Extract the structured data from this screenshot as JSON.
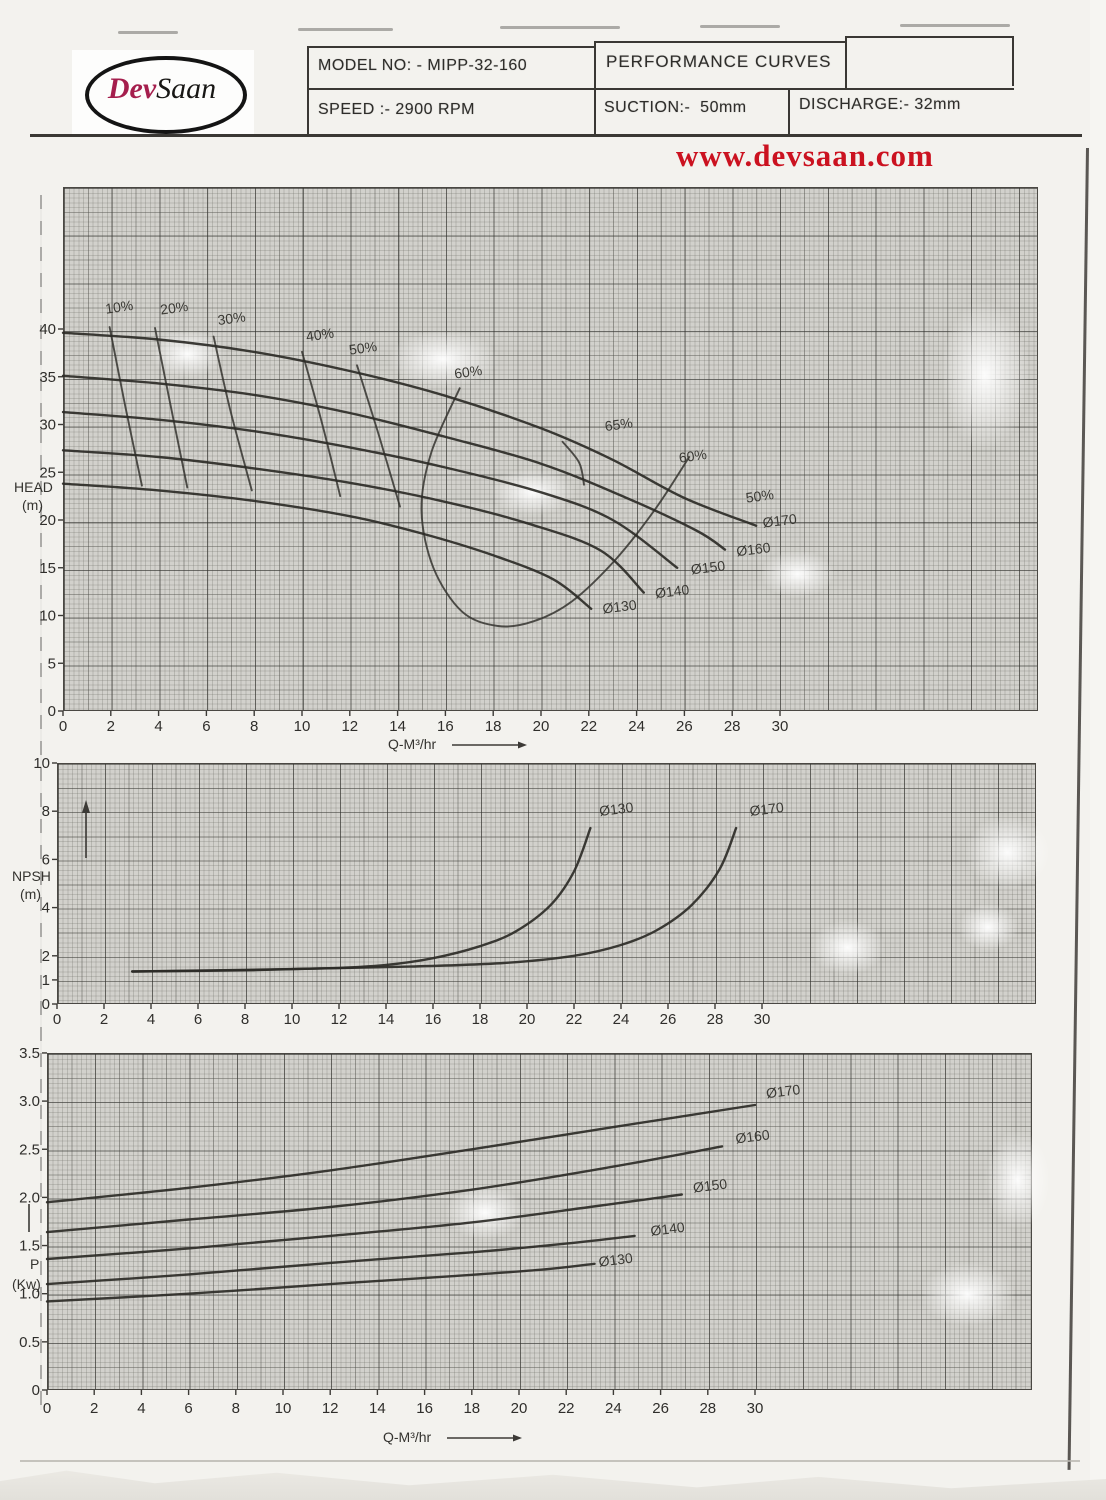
{
  "header": {
    "logo": {
      "text_red": "Dev",
      "text_black": "Saan"
    },
    "model": "MODEL NO: - MIPP-32-160",
    "title": "PERFORMANCE CURVES",
    "speed": "SPEED :- 2900 RPM",
    "suction": "SUCTION:-  50mm",
    "discharge": "DISCHARGE:- 32mm",
    "website": "www.devsaan.com"
  },
  "chart_data": [
    {
      "type": "line",
      "title": "Head capacity curves with impeller diameters and efficiency contours",
      "xlabel": "Q-M³/hr",
      "ylabel": "HEAD (m)",
      "ylabel_lines": [
        "HEAD",
        "(m)"
      ],
      "xlim": [
        0,
        40.8
      ],
      "ylim": [
        0,
        54.9
      ],
      "grid": true,
      "legend_position": "inline-labels",
      "xticks": [
        0,
        2,
        4,
        6,
        8,
        10,
        12,
        14,
        16,
        18,
        20,
        22,
        24,
        26,
        28,
        30
      ],
      "yticks": [
        [
          0,
          "0"
        ],
        [
          5,
          "5"
        ],
        [
          10,
          "10"
        ],
        [
          15,
          "15"
        ],
        [
          20,
          "20"
        ],
        [
          25,
          "25"
        ],
        [
          30,
          "30"
        ],
        [
          35,
          "35"
        ],
        [
          40,
          "40"
        ]
      ],
      "series": [
        {
          "name": "Ø170",
          "label_at": [
            29.3,
            19.2
          ],
          "points": [
            [
              0,
              39.6
            ],
            [
              4,
              38.9
            ],
            [
              8,
              37.6
            ],
            [
              12,
              35.6
            ],
            [
              16,
              33.0
            ],
            [
              20,
              29.6
            ],
            [
              23,
              26.3
            ],
            [
              26,
              22.3
            ],
            [
              29,
              19.4
            ]
          ]
        },
        {
          "name": "Ø160",
          "label_at": [
            28.2,
            16.2
          ],
          "points": [
            [
              0,
              35.1
            ],
            [
              4,
              34.3
            ],
            [
              8,
              33.1
            ],
            [
              12,
              31.2
            ],
            [
              16,
              28.7
            ],
            [
              20,
              25.9
            ],
            [
              23.5,
              22.4
            ],
            [
              26.5,
              18.9
            ],
            [
              27.7,
              16.9
            ]
          ]
        },
        {
          "name": "Ø150",
          "label_at": [
            26.3,
            14.3
          ],
          "points": [
            [
              0,
              31.3
            ],
            [
              4,
              30.5
            ],
            [
              8,
              29.3
            ],
            [
              12,
              27.6
            ],
            [
              16,
              25.5
            ],
            [
              20,
              22.9
            ],
            [
              23,
              20.0
            ],
            [
              25.7,
              15.0
            ]
          ]
        },
        {
          "name": "Ø140",
          "label_at": [
            24.8,
            11.8
          ],
          "points": [
            [
              0,
              27.3
            ],
            [
              4,
              26.6
            ],
            [
              8,
              25.4
            ],
            [
              12,
              23.9
            ],
            [
              16,
              21.9
            ],
            [
              19.5,
              19.6
            ],
            [
              22.5,
              16.8
            ],
            [
              24.3,
              12.4
            ]
          ]
        },
        {
          "name": "Ø130",
          "label_at": [
            22.6,
            10.2
          ],
          "points": [
            [
              0,
              23.8
            ],
            [
              4,
              23.1
            ],
            [
              8,
              22.0
            ],
            [
              12,
              20.4
            ],
            [
              15,
              18.6
            ],
            [
              18,
              16.3
            ],
            [
              20.5,
              13.8
            ],
            [
              22.1,
              10.7
            ]
          ]
        }
      ],
      "efficiency_lines": [
        {
          "label": "10%",
          "points": [
            [
              1.95,
              40.2
            ],
            [
              2.6,
              32.0
            ],
            [
              3.3,
              23.6
            ]
          ]
        },
        {
          "label": "20%",
          "points": [
            [
              3.85,
              40.1
            ],
            [
              4.5,
              32.0
            ],
            [
              5.2,
              23.4
            ]
          ]
        },
        {
          "label": "30%",
          "points": [
            [
              6.3,
              39.2
            ],
            [
              7.0,
              31.5
            ],
            [
              7.9,
              23.1
            ]
          ]
        },
        {
          "label": "40%",
          "points": [
            [
              10.0,
              37.6
            ],
            [
              10.8,
              30.5
            ],
            [
              11.6,
              22.5
            ]
          ]
        },
        {
          "label": "50%",
          "points": [
            [
              12.3,
              36.2
            ],
            [
              13.2,
              29.0
            ],
            [
              14.1,
              21.4
            ]
          ]
        },
        {
          "label": "60%",
          "points": [
            [
              16.6,
              33.8
            ],
            [
              15.4,
              27.0
            ],
            [
              15.0,
              21.0
            ],
            [
              15.5,
              15.0
            ],
            [
              16.7,
              10.4
            ],
            [
              18.2,
              8.9
            ],
            [
              19.7,
              9.4
            ],
            [
              21.3,
              11.5
            ],
            [
              23.1,
              15.8
            ],
            [
              24.8,
              21.2
            ],
            [
              26.2,
              26.6
            ]
          ]
        },
        {
          "label": "65%",
          "points": [
            [
              20.9,
              28.2
            ],
            [
              21.6,
              26.0
            ],
            [
              21.8,
              23.7
            ]
          ]
        }
      ],
      "efficiency_labels": [
        {
          "text": "10%",
          "at": [
            1.8,
            41.6
          ]
        },
        {
          "text": "20%",
          "at": [
            4.1,
            41.5
          ]
        },
        {
          "text": "30%",
          "at": [
            6.5,
            40.4
          ]
        },
        {
          "text": "40%",
          "at": [
            10.2,
            38.7
          ]
        },
        {
          "text": "50%",
          "at": [
            12.0,
            37.3
          ]
        },
        {
          "text": "60%",
          "at": [
            16.4,
            34.8
          ]
        },
        {
          "text": "65%",
          "at": [
            22.7,
            29.3
          ]
        },
        {
          "text": "60%",
          "at": [
            25.8,
            26.0
          ]
        },
        {
          "text": "50%",
          "at": [
            28.6,
            21.8
          ]
        }
      ]
    },
    {
      "type": "line",
      "title": "NPSH curves",
      "xlabel": "",
      "ylabel": "NPSH (m)",
      "ylabel_lines": [
        "NPSH",
        "(m)"
      ],
      "xlim": [
        0,
        41.7
      ],
      "ylim": [
        0,
        10
      ],
      "grid": true,
      "legend_position": "inline-labels",
      "xticks": [
        0,
        2,
        4,
        6,
        8,
        10,
        12,
        14,
        16,
        18,
        20,
        22,
        24,
        26,
        28,
        30
      ],
      "yticks": [
        [
          0,
          "0"
        ],
        [
          1,
          "1"
        ],
        [
          2,
          "2"
        ],
        [
          4,
          "4"
        ],
        [
          6,
          "6"
        ],
        [
          8,
          "8"
        ],
        [
          10,
          "10"
        ]
      ],
      "series": [
        {
          "name": "Ø130",
          "label_at": [
            23.1,
            7.8
          ],
          "points": [
            [
              3.2,
              1.35
            ],
            [
              8,
              1.4
            ],
            [
              12,
              1.5
            ],
            [
              14,
              1.62
            ],
            [
              16,
              1.9
            ],
            [
              18,
              2.4
            ],
            [
              19.5,
              3.0
            ],
            [
              21,
              4.1
            ],
            [
              22,
              5.5
            ],
            [
              22.7,
              7.3
            ]
          ]
        },
        {
          "name": "Ø170",
          "label_at": [
            29.5,
            7.8
          ],
          "points": [
            [
              3.2,
              1.35
            ],
            [
              10,
              1.45
            ],
            [
              15,
              1.55
            ],
            [
              19,
              1.7
            ],
            [
              22,
              2.0
            ],
            [
              24,
              2.45
            ],
            [
              25.5,
              3.05
            ],
            [
              27,
              4.1
            ],
            [
              28.2,
              5.6
            ],
            [
              28.9,
              7.3
            ]
          ]
        }
      ]
    },
    {
      "type": "line",
      "title": "Power curves",
      "xlabel": "Q-M³/hr",
      "ylabel": "P (Kw)",
      "ylabel_lines": [
        "P",
        "(Kw)"
      ],
      "xlim": [
        0,
        41.9
      ],
      "ylim": [
        0,
        3.5
      ],
      "grid": true,
      "legend_position": "inline-labels",
      "xticks": [
        0,
        2,
        4,
        6,
        8,
        10,
        12,
        14,
        16,
        18,
        20,
        22,
        24,
        26,
        28,
        30
      ],
      "yticks": [
        [
          0,
          "0"
        ],
        [
          0.5,
          "0.5"
        ],
        [
          1,
          "1.0"
        ],
        [
          1.5,
          "1.5"
        ],
        [
          2,
          "2.0"
        ],
        [
          2.5,
          "2.5"
        ],
        [
          3,
          "3.0"
        ],
        [
          3.5,
          "3.5"
        ]
      ],
      "series": [
        {
          "name": "Ø170",
          "label_at": [
            30.5,
            3.03
          ],
          "points": [
            [
              0,
              1.95
            ],
            [
              6,
              2.1
            ],
            [
              12,
              2.28
            ],
            [
              18,
              2.5
            ],
            [
              24,
              2.73
            ],
            [
              30,
              2.96
            ]
          ]
        },
        {
          "name": "Ø160",
          "label_at": [
            29.2,
            2.56
          ],
          "points": [
            [
              0,
              1.64
            ],
            [
              6,
              1.77
            ],
            [
              12,
              1.9
            ],
            [
              18,
              2.08
            ],
            [
              24,
              2.32
            ],
            [
              28.6,
              2.53
            ]
          ]
        },
        {
          "name": "Ø150",
          "label_at": [
            27.4,
            2.05
          ],
          "points": [
            [
              0,
              1.36
            ],
            [
              6,
              1.47
            ],
            [
              12,
              1.6
            ],
            [
              18,
              1.74
            ],
            [
              23,
              1.9
            ],
            [
              26.9,
              2.03
            ]
          ]
        },
        {
          "name": "Ø140",
          "label_at": [
            25.6,
            1.6
          ],
          "points": [
            [
              0,
              1.1
            ],
            [
              6,
              1.2
            ],
            [
              12,
              1.32
            ],
            [
              18,
              1.43
            ],
            [
              22,
              1.52
            ],
            [
              24.9,
              1.6
            ]
          ]
        },
        {
          "name": "Ø130",
          "label_at": [
            23.4,
            1.28
          ],
          "points": [
            [
              0,
              0.92
            ],
            [
              6,
              1.0
            ],
            [
              12,
              1.1
            ],
            [
              17,
              1.18
            ],
            [
              21,
              1.25
            ],
            [
              23.2,
              1.31
            ]
          ]
        }
      ]
    }
  ],
  "colors": {
    "accent_red": "#cb1220",
    "logo_red": "#a51e4d",
    "ink": "#2c2b27",
    "paper": "#f3f2ee",
    "grid_bg": "#d2d1cc"
  }
}
